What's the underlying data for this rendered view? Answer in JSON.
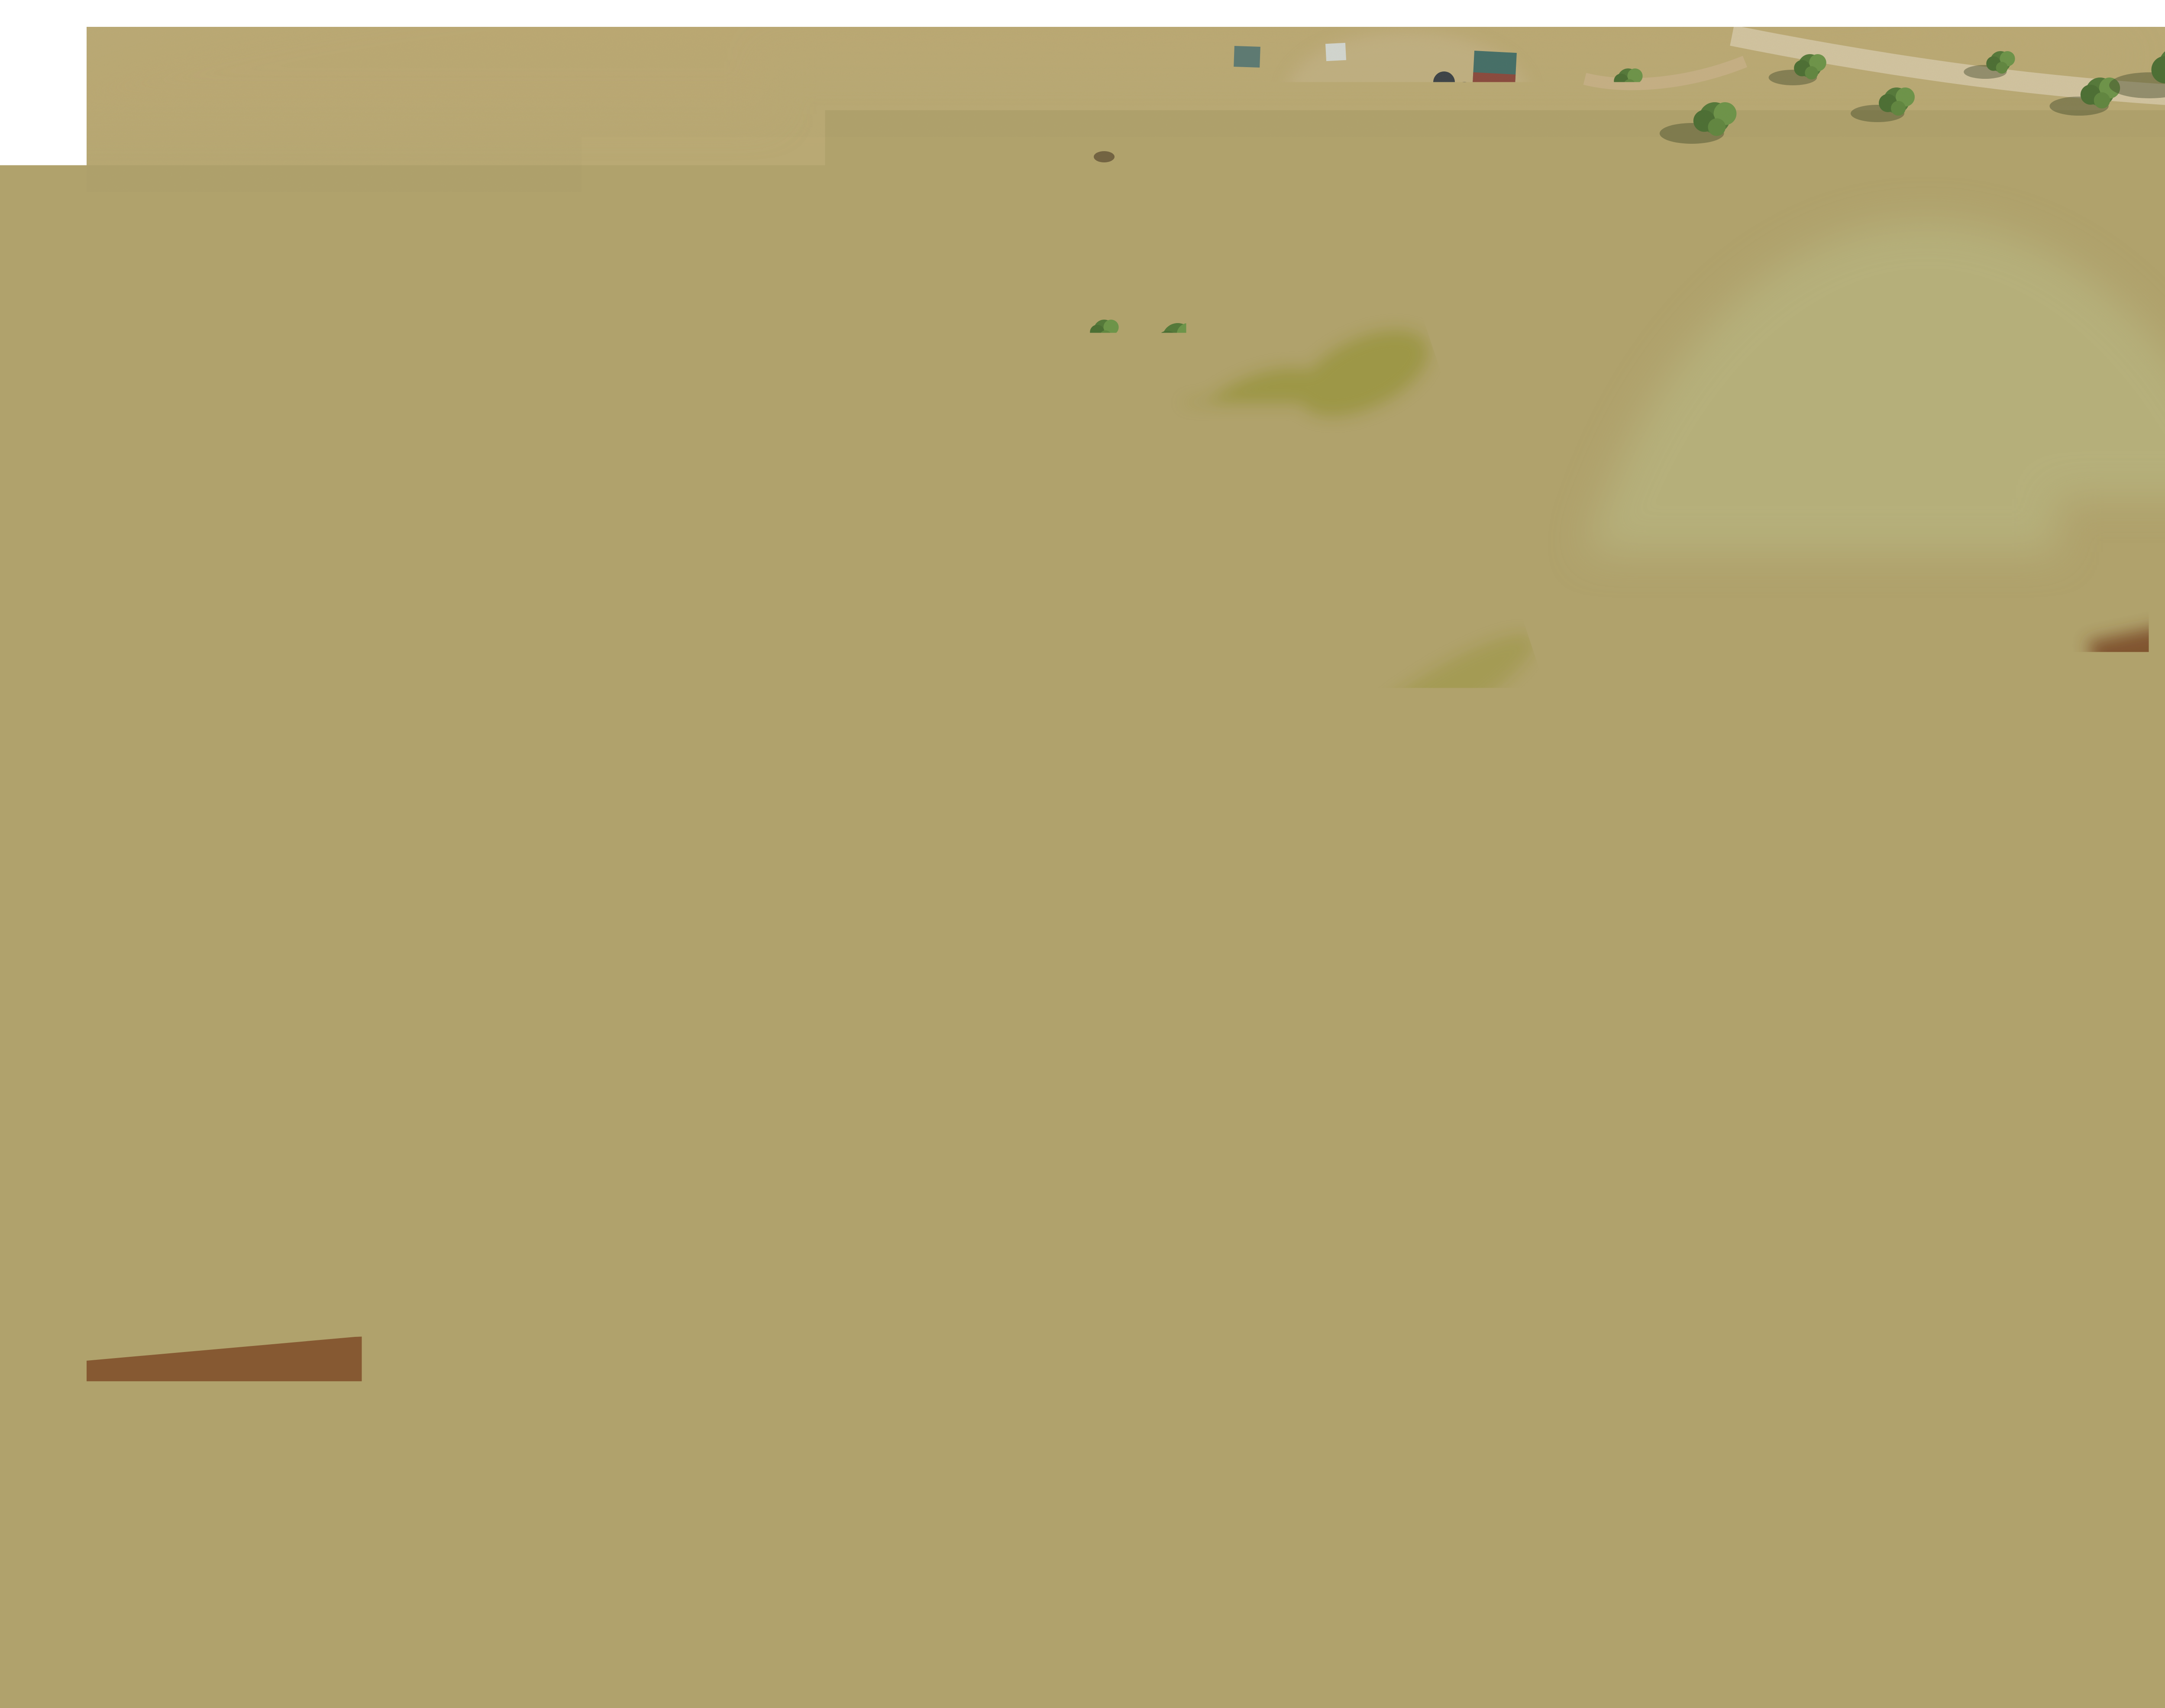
{
  "photo": {
    "watermark": "Indicative Boundary"
  },
  "lots": [
    {
      "number": "47",
      "area": "1.00ha"
    },
    {
      "number": "48",
      "area": "1.00ha"
    }
  ],
  "footer": {
    "brand": "RayWhite.",
    "reg": "®",
    "office": "Rural Inverell"
  },
  "colors": {
    "lot_highlight": "#c9b71f",
    "lot_boundary": "#ffffff",
    "lot_label": "#4b4b44",
    "brand_yellow": "#ffdf00",
    "brand_text": "#47474b",
    "watermark": "#ffffff"
  }
}
